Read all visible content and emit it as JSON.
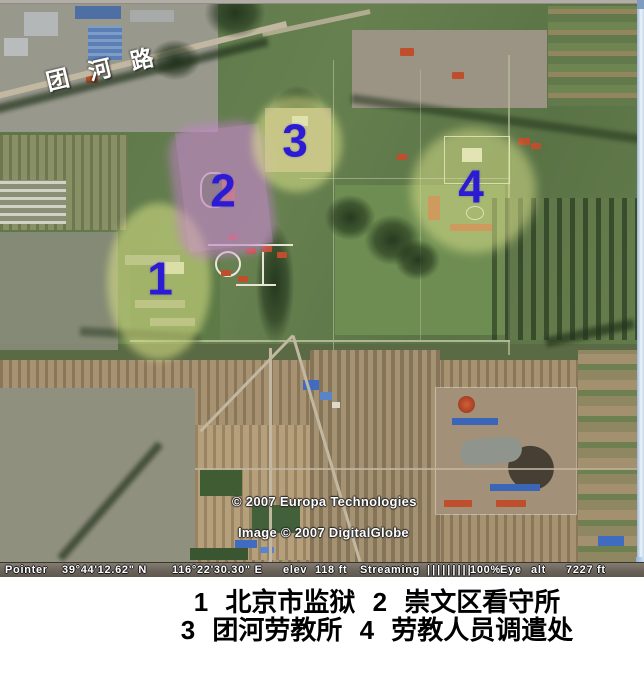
{
  "map": {
    "road_label": "团 河 路",
    "markers": [
      {
        "label": "1"
      },
      {
        "label": "2"
      },
      {
        "label": "3"
      },
      {
        "label": "4"
      }
    ],
    "marker_color": "#2b1bd2",
    "highlight_yellow": "rgba(224,232,136,0.52)",
    "highlight_purple": "rgba(202,128,214,0.48)",
    "credits": {
      "line1": "© 2007 Europa Technologies",
      "line2": "Image © 2007 DigitalGlobe"
    }
  },
  "status_bar": {
    "pointer_label": "Pointer",
    "latitude": "39°44'12.62\" N",
    "longitude": "116°22'30.30\" E",
    "elev_label": "elev",
    "elev_value": "118 ft",
    "streaming_label": "Streaming",
    "streaming_bars": "|||||||||",
    "streaming_pct": "100%",
    "eye_label": "Eye",
    "alt_label": "alt",
    "alt_value": "7227 ft"
  },
  "caption": {
    "line1": "1 北京市监狱 2 崇文区看守所",
    "line2": "3 团河劳教所 4 劳教人员调遣处"
  }
}
